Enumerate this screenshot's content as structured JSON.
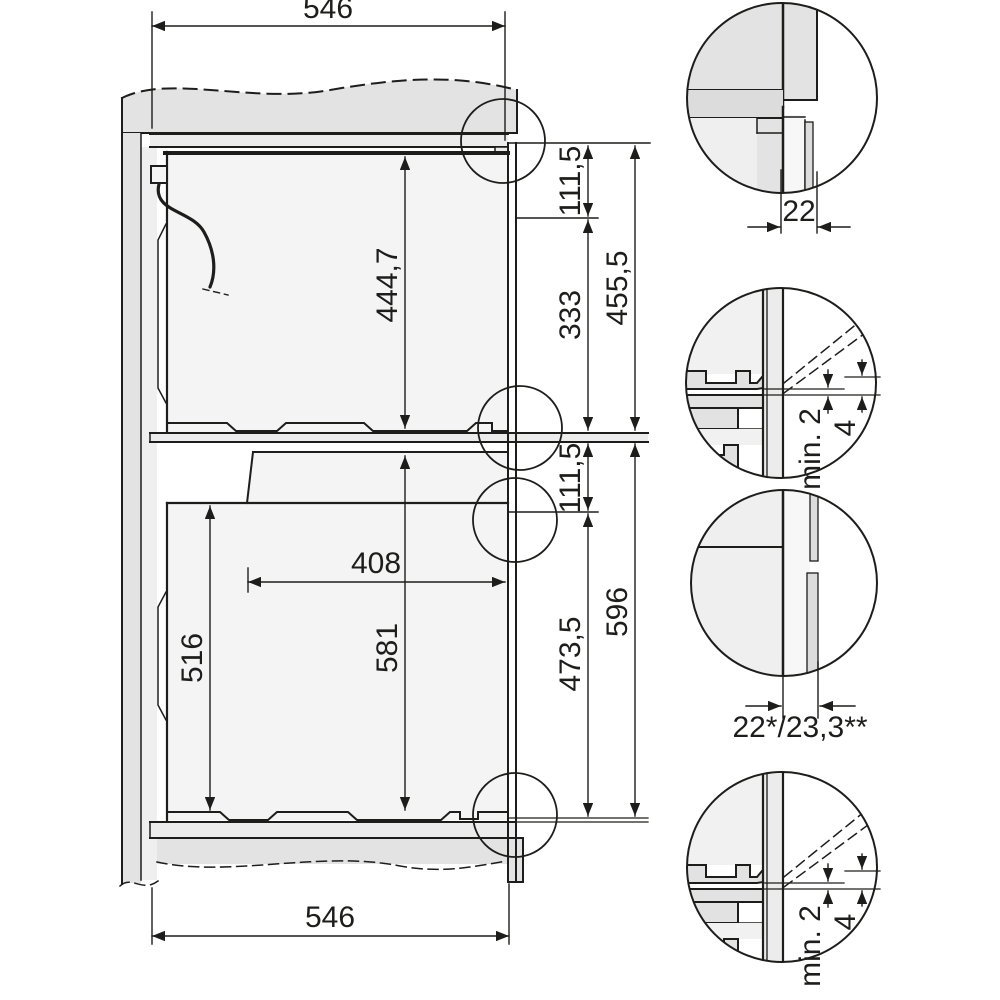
{
  "colors": {
    "line": "#1d1d1b",
    "carcass_gray": "#e3e3e3",
    "panel_gray": "#dcdcdc",
    "interior_gray": "#f4f4f4",
    "background": "#ffffff"
  },
  "main_view": {
    "dim_width_top": "546",
    "dim_width_bottom": "546",
    "upper_niche": {
      "dim_front_gap": "111,5",
      "dim_appliance_height": "444,7",
      "dim_rear_height": "333",
      "dim_total_height": "455,5"
    },
    "lower_niche": {
      "dim_front_gap": "111,5",
      "dim_recess_depth": "408",
      "dim_front_height": "516",
      "dim_appliance_height": "581",
      "dim_rear_height": "473,5",
      "dim_total_height": "596"
    }
  },
  "details": {
    "top_corner": {
      "dim_edge": "22"
    },
    "mid_junction": {
      "dim_gap_min": "min. 2",
      "dim_offset": "4"
    },
    "front_panel": {
      "dim_thickness": "22*/23,3**"
    },
    "bottom_junction": {
      "dim_gap_min": "min. 2",
      "dim_offset": "4"
    }
  }
}
